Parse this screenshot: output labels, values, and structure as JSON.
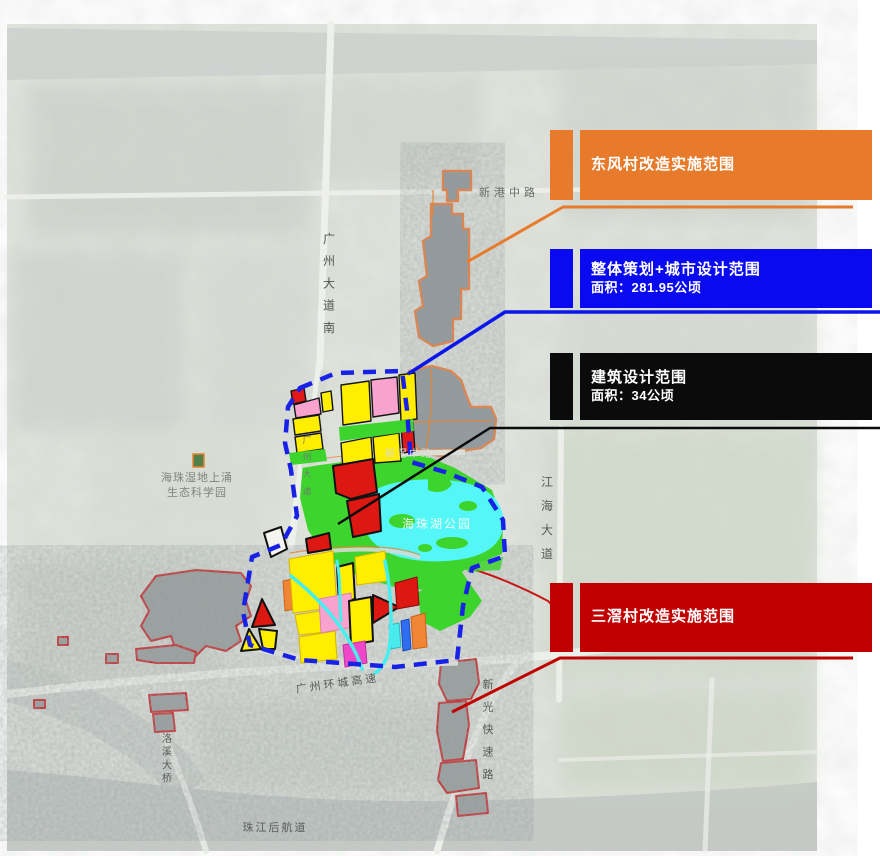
{
  "legend": {
    "items": [
      {
        "id": "dongfeng",
        "label": "东风村改造实施范围",
        "area": "",
        "color": "#E87B2B"
      },
      {
        "id": "overall",
        "label": "整体策划+城市设计范围",
        "area": "面积：281.95公顷",
        "color": "#0A0AF0"
      },
      {
        "id": "building",
        "label": "建筑设计范围",
        "area": "面积：34公顷",
        "color": "#0B0B0B"
      },
      {
        "id": "sanjiao",
        "label": "三滘村改造实施范围",
        "area": "",
        "color": "#C00000"
      }
    ]
  },
  "map_labels": {
    "xingang_zhong_lu": "新港中路",
    "guangzhou_dadao_nan": "广州大道南",
    "guangzhou_dadao": "广州大道",
    "haizhu_wetland_line1": "海珠湿地上涌",
    "haizhu_wetland_line2": "生态科学园",
    "xinjiao_zhong_lu": "新滘中路",
    "haizhuhu_park": "海珠湖公园",
    "jianghai_dadao": "江海大道",
    "guangzhou_huancheng_gaosu": "广州环城高速",
    "xinguang_kuaisu_lu": "新光快速路",
    "luoxi_daqiao": "洛溪大桥",
    "zhujiang_hou_hangdao": "珠江后航道"
  },
  "colors": {
    "legend_orange": "#E87B2B",
    "legend_blue": "#0A0AF0",
    "legend_black": "#0B0B0B",
    "legend_red": "#C00000",
    "boundary_blue": "#1822E6",
    "village_outline_orange": "#E8822D",
    "village_outline_red": "#C81414",
    "parcel_yellow": "#FFEE00",
    "parcel_pink": "#F7A3CD",
    "parcel_magenta": "#F047C8",
    "parcel_red": "#E01818",
    "parcel_orange": "#EF8535",
    "parcel_blue": "#2F6DF2",
    "park_green": "#3ED42E",
    "lake_cyan": "#55F6F7"
  }
}
